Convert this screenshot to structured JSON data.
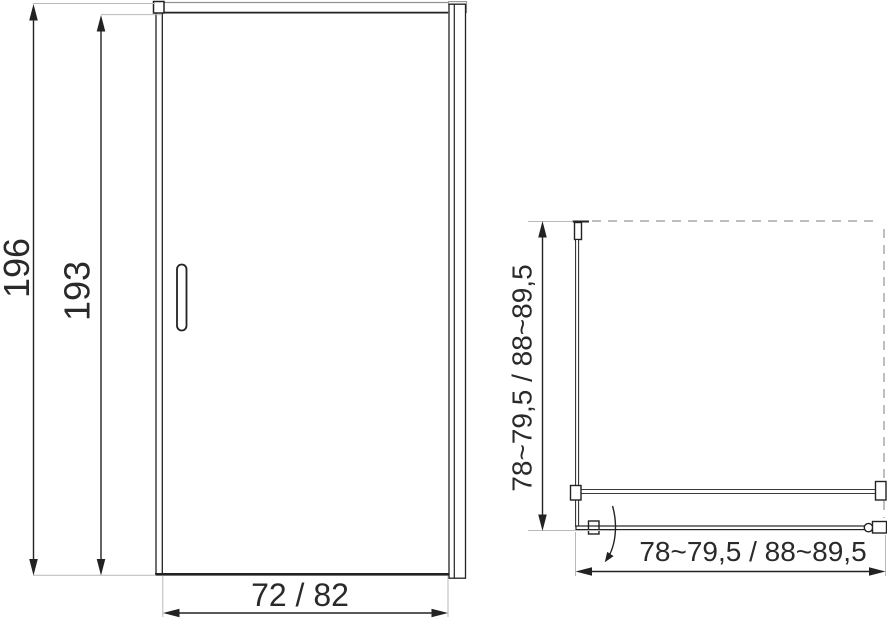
{
  "drawing": {
    "kind": "shower-door-dimension-diagram",
    "front_view": {
      "dim_total_height": "196",
      "dim_door_height": "193",
      "dim_width": "72 / 82"
    },
    "plan_view": {
      "dim_depth": "78~79,5 / 88~89,5",
      "dim_width": "78~79,5 / 88~89,5"
    },
    "colors": {
      "line": "#222222",
      "extension_line": "#b9b9b9",
      "dashed_line": "#a8a8a8",
      "rail_gray": "#8f8f8f",
      "background": "#ffffff"
    }
  }
}
